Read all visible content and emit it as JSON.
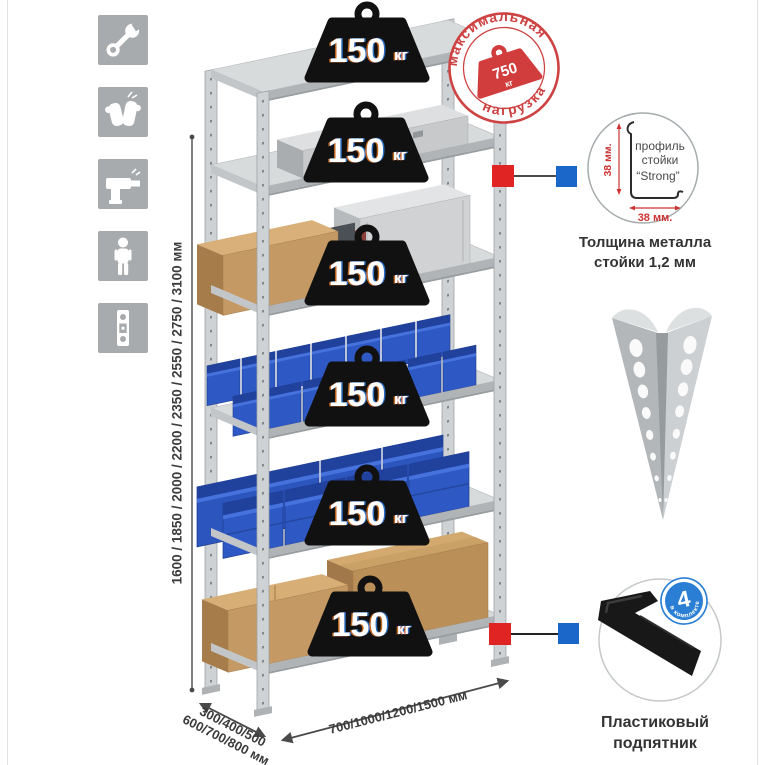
{
  "sidebar": {
    "icons": [
      {
        "name": "wrench"
      },
      {
        "name": "gloves"
      },
      {
        "name": "drill"
      },
      {
        "name": "person"
      },
      {
        "name": "level"
      }
    ]
  },
  "dimensions": {
    "height": "1600 / 1850 / 2000 / 2200 / 2350 / 2550 / 2750 / 3100 мм",
    "depth_line1": "300/400/500",
    "depth_line2": "600/700/800 мм",
    "width": "700/1000/1200/1500 мм"
  },
  "shelf_load": {
    "value": "150",
    "unit": "кг"
  },
  "max_load_stamp": {
    "arc_top": "максимальная",
    "arc_bottom": "нагрузка",
    "value": "750",
    "unit": "кг"
  },
  "profile_detail": {
    "dim_vertical": "38 мм.",
    "dim_horizontal": "38 мм.",
    "label_line1": "профиль",
    "label_line2": "стойки",
    "label_line3": "“Strong”",
    "caption_line1": "Толщина металла",
    "caption_line2": "стойки 1,2 мм"
  },
  "foot_detail": {
    "badge_value": "4",
    "badge_ring_text": "в комплекте",
    "caption_line1": "Пластиковый",
    "caption_line2": "подпятник"
  },
  "colors": {
    "stamp_red": "#cd4343",
    "marker_red": "#e02424",
    "marker_blue": "#1a67c9",
    "bin_blue": "#2e59c4",
    "icon_gray": "#a8abad"
  }
}
